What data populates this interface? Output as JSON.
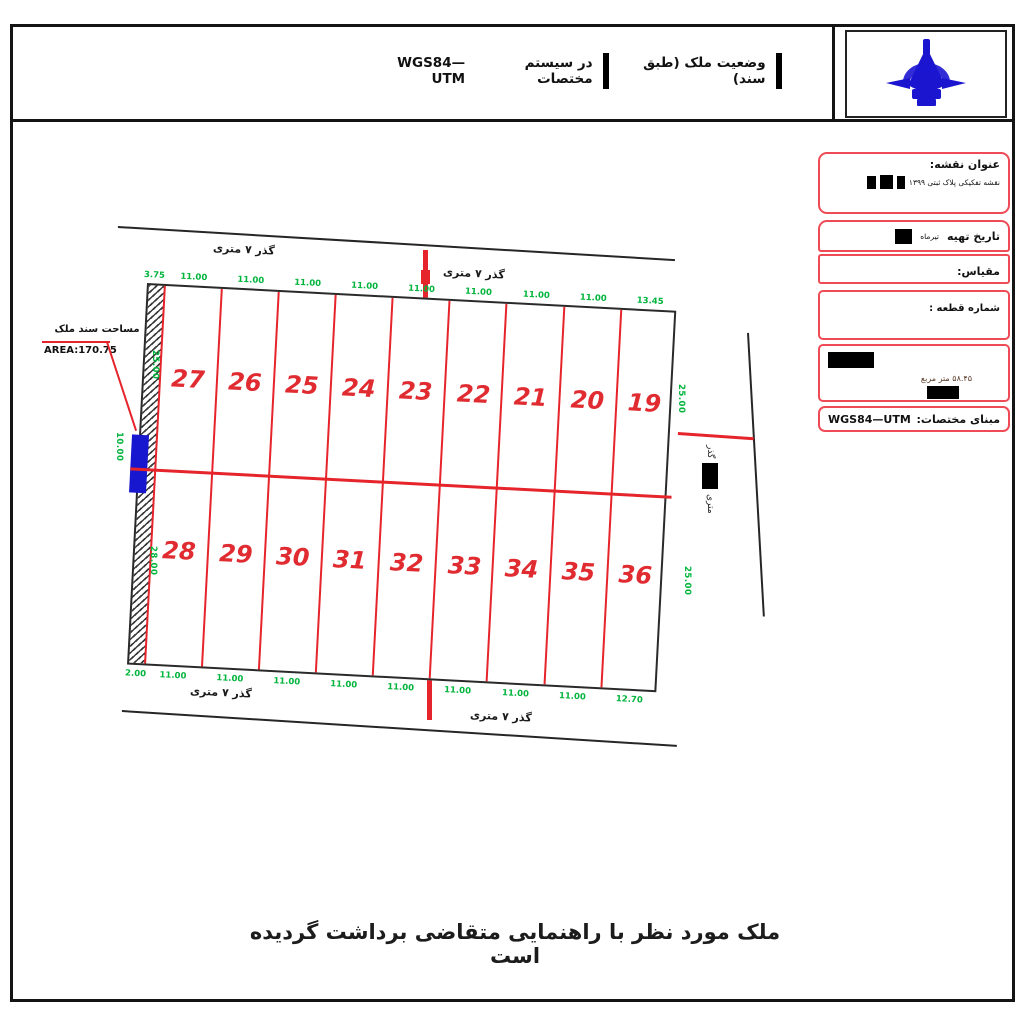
{
  "header": {
    "title_property": "وضعیت ملک  (طبق سند)",
    "title_middle": "در سیستم مختصات",
    "title_system": "WGS84—UTM"
  },
  "logo": {
    "name": "survey-organization-emblem",
    "color": "#1b15d0"
  },
  "info_panel": {
    "map_title_label": "عنوان نقشه:",
    "map_title_value": "نقشه تفکیکی پلاک ثبتی ۱۳۹۹",
    "date_label": "تاریخ تهیه",
    "date_value": "تیرماه",
    "scale_label": "مقیاس:",
    "parcel_no_label": "شماره قطعه :",
    "area_value": "۵۸.۴۵ متر مربع",
    "datum_label": "مبنای مختصات:",
    "datum_value": "WGS84—UTM",
    "border_color": "#ef4b57"
  },
  "drawing": {
    "area_label_fa": "مساحت سند ملک",
    "area_label_en": "AREA:170.75",
    "road_label": "گذر ۷ متری",
    "right_road_label_top": "گذر",
    "right_road_label_bottom": "متری",
    "parcels_top": [
      "27",
      "26",
      "25",
      "24",
      "23",
      "22",
      "21",
      "20",
      "19"
    ],
    "parcels_bottom": [
      "28",
      "29",
      "30",
      "31",
      "32",
      "33",
      "34",
      "35",
      "36"
    ],
    "dims_top": [
      "3.75",
      "11.00",
      "11.00",
      "11.00",
      "11.00",
      "11.00",
      "11.00",
      "11.00",
      "11.00",
      "13.45"
    ],
    "dims_bottom": [
      "2.00",
      "11.00",
      "11.00",
      "11.00",
      "11.00",
      "11.00",
      "11.00",
      "11.00",
      "11.00",
      "12.70"
    ],
    "dim_left_upper": "25.00",
    "dim_left_blue": "10.00",
    "dim_left_lower": "28.00",
    "dim_right_upper": "25.00",
    "dim_right_lower": "25.00",
    "colors": {
      "parcel_line": "#e6242b",
      "dimension": "#00b43c",
      "road": "#262626",
      "highlight": "#1717cf"
    }
  },
  "footer": {
    "note": "ملک مورد نظر با راهنمایی متقاضی برداشت گردیده است"
  }
}
